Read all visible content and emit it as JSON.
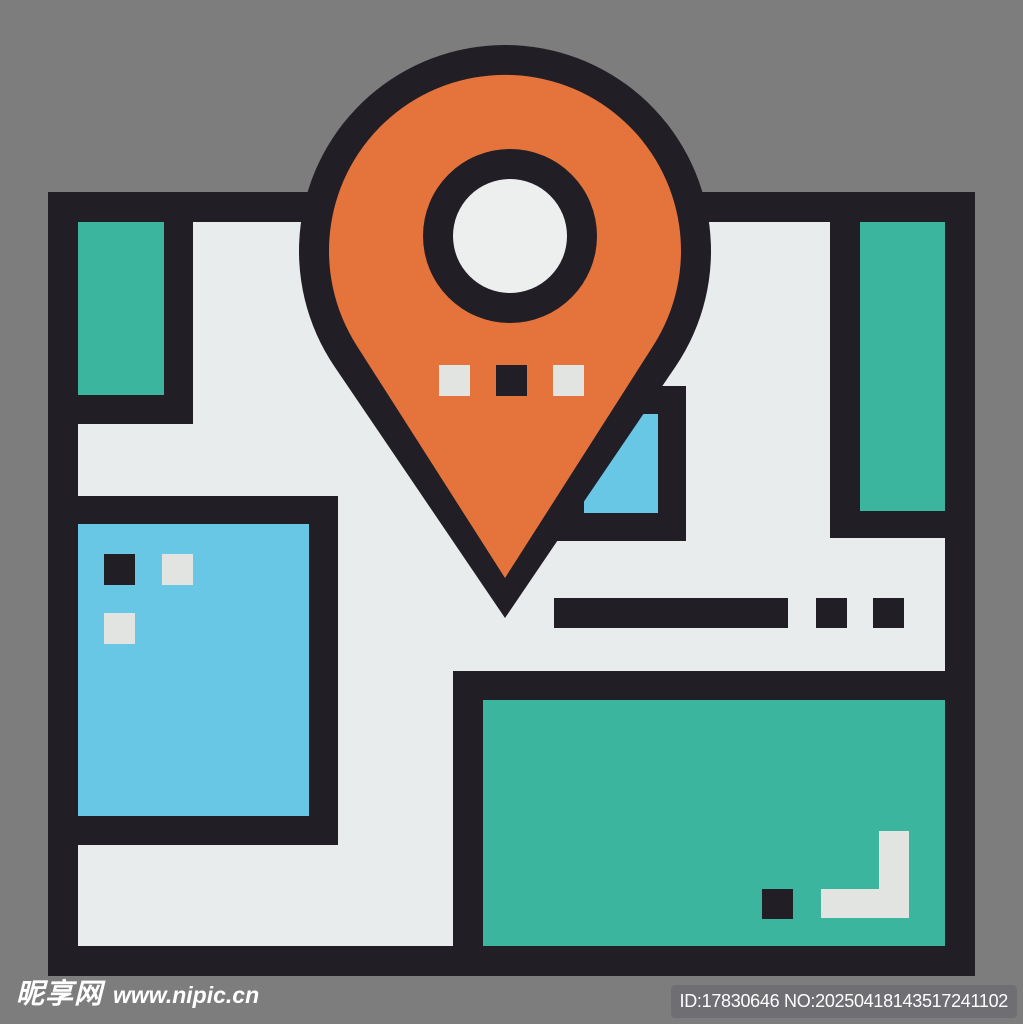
{
  "background_color": "#7d7d7d",
  "icon": {
    "name": "map-with-location-pin-icon",
    "style": "flat outline illustration",
    "colors": {
      "bg": "#7d7d7d",
      "outline": "#221e25",
      "orange": "#e5743c",
      "teal": "#3bb59d",
      "blue": "#68c7e5",
      "map": "#e9ecec",
      "white": "#e2e4e2",
      "hole": "#edefef",
      "badge": "#6f6f73",
      "wm": "#ffffff"
    }
  },
  "watermark": {
    "site_name": "昵享网",
    "site_url": "www.nipic.cn",
    "id_text": "ID:17830646 NO:20250418143517241102"
  }
}
